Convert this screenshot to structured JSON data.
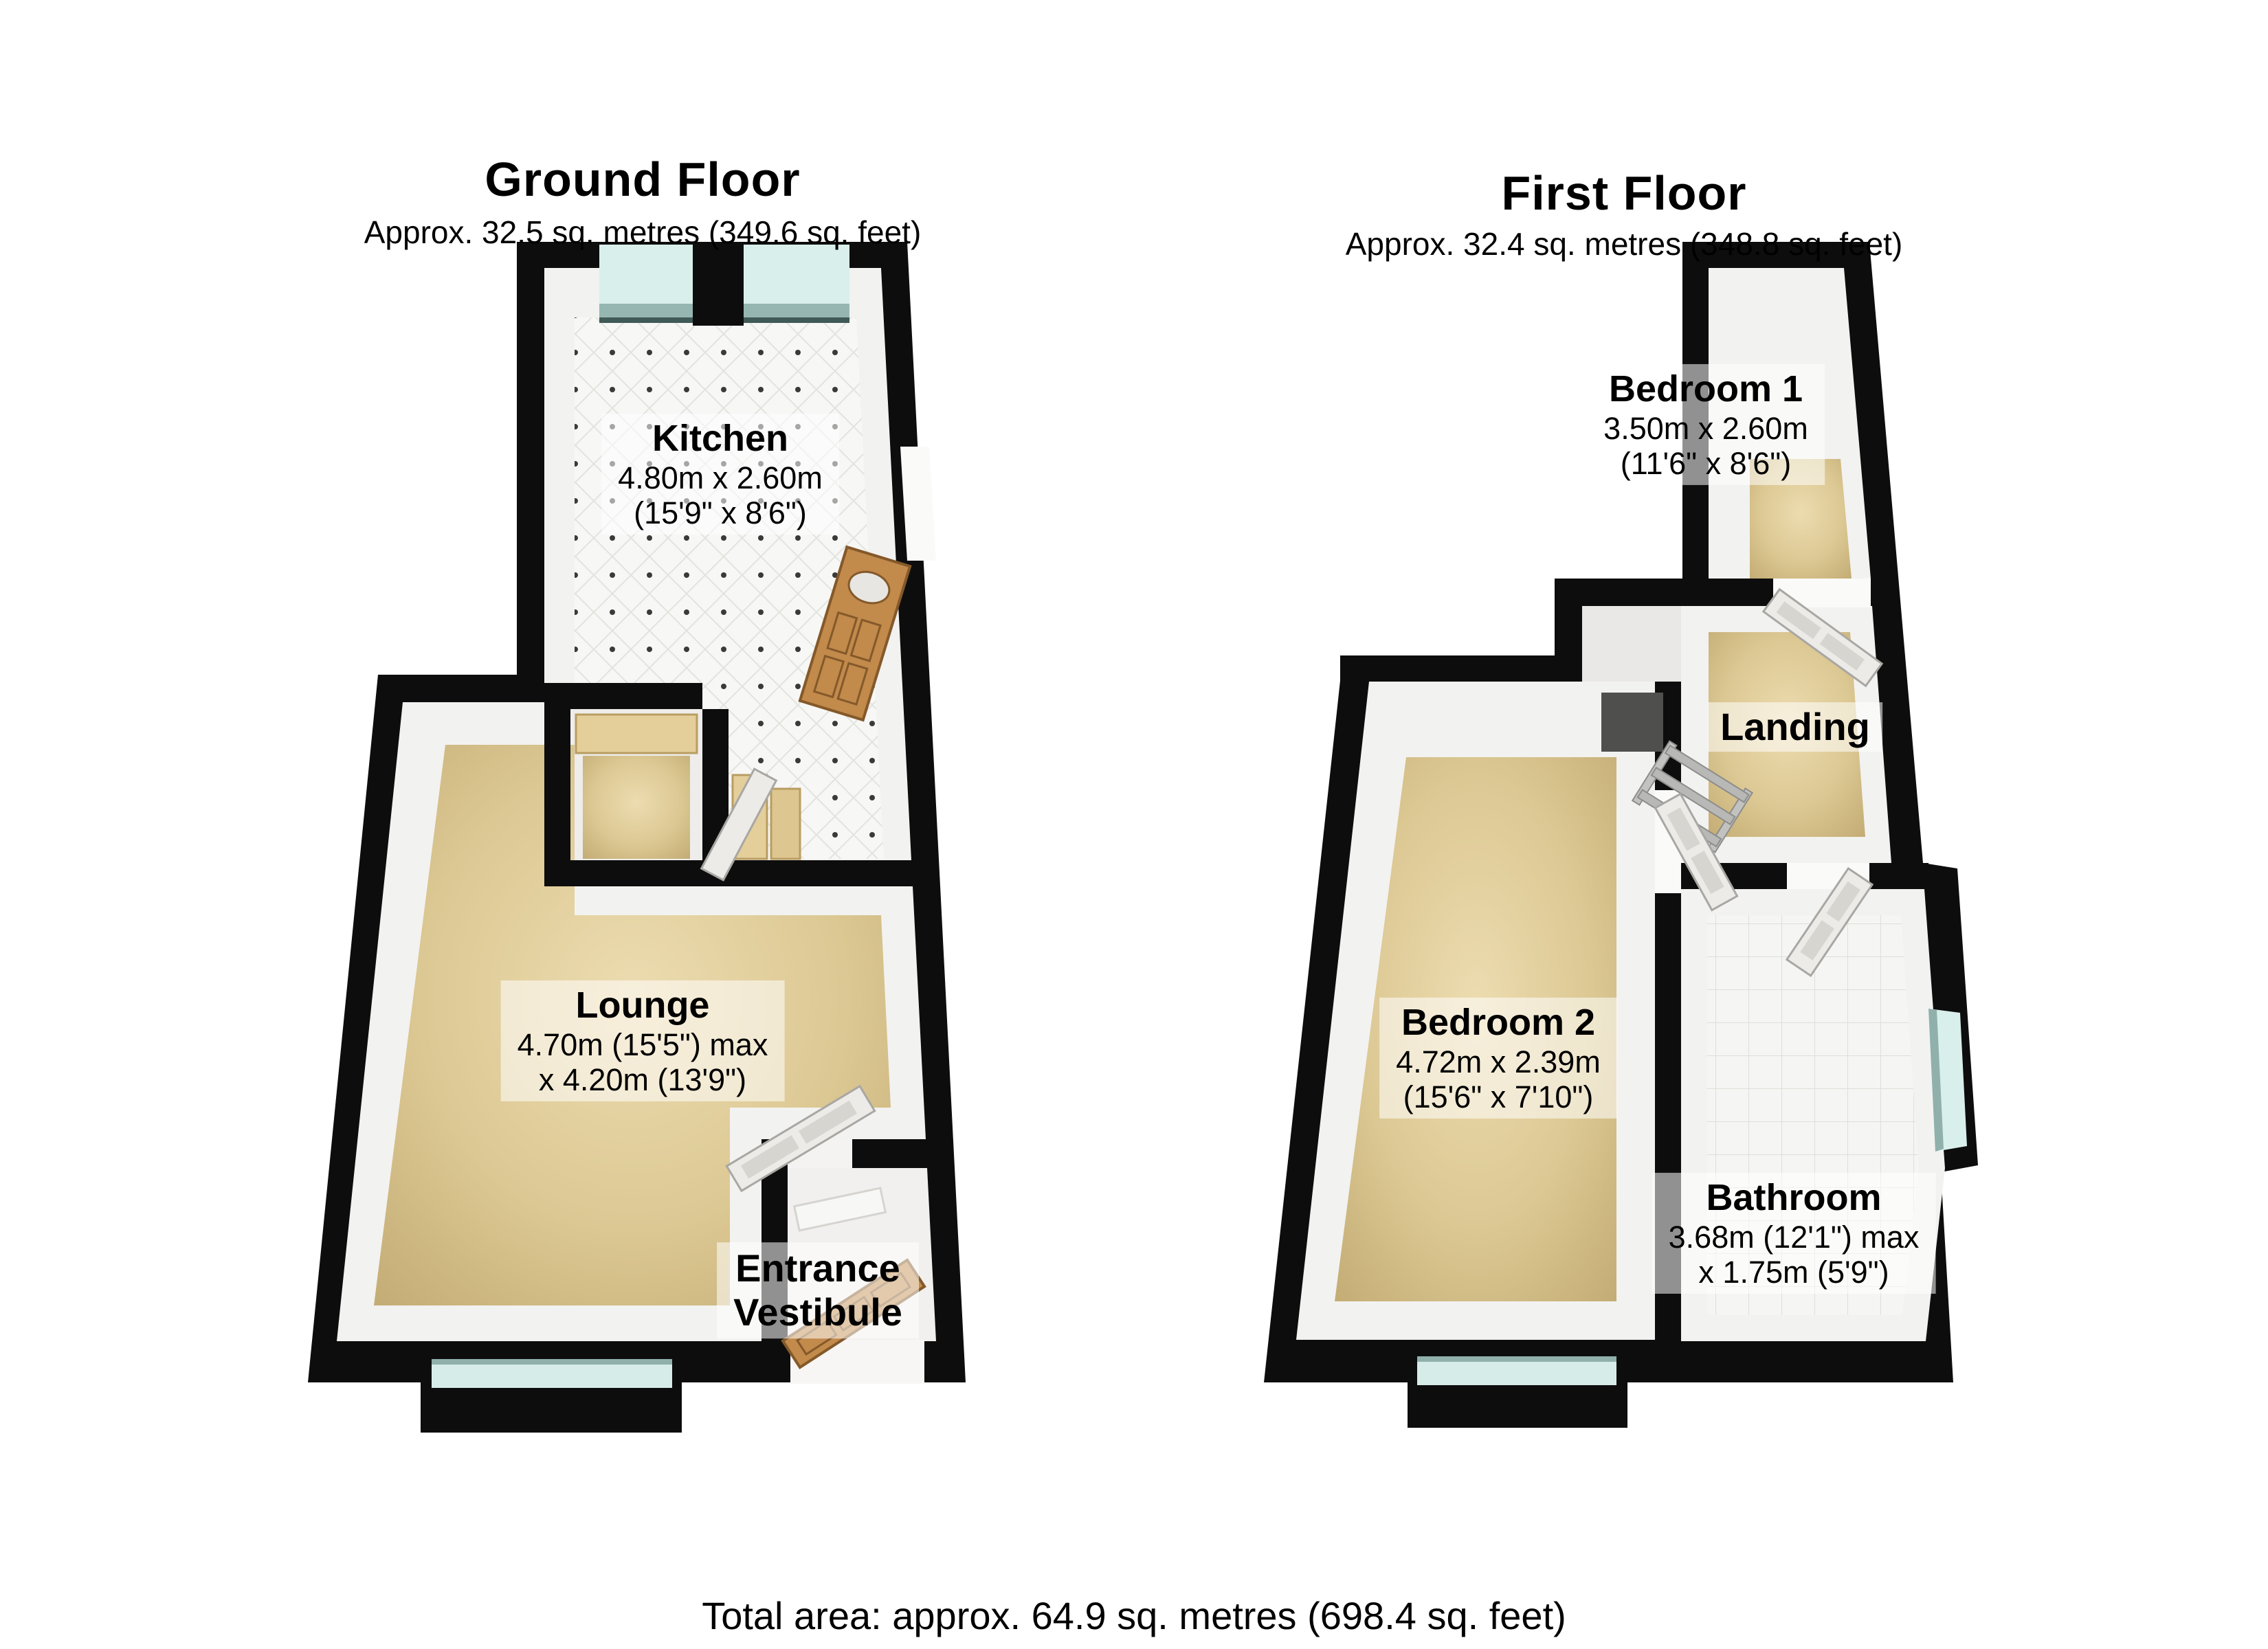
{
  "ground_floor": {
    "title": "Ground Floor",
    "subtitle": "Approx. 32.5 sq. metres (349.6 sq. feet)",
    "rooms": {
      "kitchen": {
        "name": "Kitchen",
        "dim1": "4.80m x 2.60m",
        "dim2": "(15'9\" x 8'6\")"
      },
      "lounge": {
        "name": "Lounge",
        "dim1": "4.70m (15'5\") max",
        "dim2": "x 4.20m (13'9\")"
      },
      "entrance_vestibule": {
        "name_line1": "Entrance",
        "name_line2": "Vestibule"
      }
    }
  },
  "first_floor": {
    "title": "First Floor",
    "subtitle": "Approx. 32.4 sq. metres (348.8 sq. feet)",
    "rooms": {
      "bedroom1": {
        "name": "Bedroom 1",
        "dim1": "3.50m x 2.60m",
        "dim2": "(11'6\" x 8'6\")"
      },
      "landing": {
        "name": "Landing"
      },
      "bedroom2": {
        "name": "Bedroom 2",
        "dim1": "4.72m x 2.39m",
        "dim2": "(15'6\" x 7'10\")"
      },
      "bathroom": {
        "name": "Bathroom",
        "dim1": "3.68m (12'1\") max",
        "dim2": "x 1.75m (5'9\")"
      }
    }
  },
  "footer": {
    "total_area": "Total area: approx. 64.9 sq. metres (698.4 sq. feet)"
  },
  "colors": {
    "wall": "#0d0d0d",
    "carpet": "#d8c491",
    "kitchen_tile": "#f6f6f4",
    "window_glass": "#d9efeb",
    "window_sill": "#96b7b1",
    "wood_door": "#c28a4b",
    "white_door": "#edebe7",
    "label_background": "rgba(255,255,255,0.55)"
  }
}
